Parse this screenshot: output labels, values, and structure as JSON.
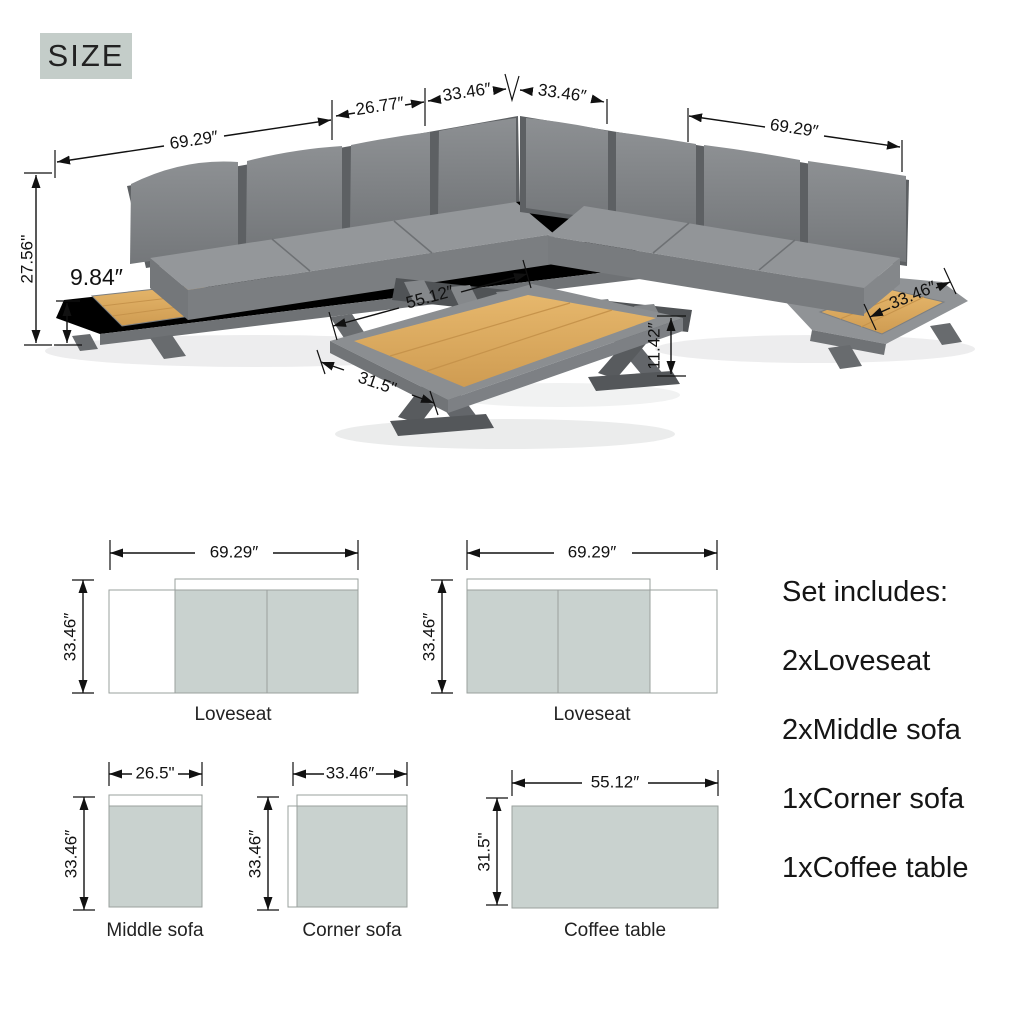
{
  "size_badge": "SIZE",
  "colors": {
    "badge_bg": "#c4cdc9",
    "diagram_fill": "#c9d2cf",
    "wood": "#ddab60",
    "sofa_gray": "#83868a",
    "dim_text": "#111111"
  },
  "main_view": {
    "dims": {
      "left_width": "69.29″",
      "middle_seat_width": "26.77″",
      "corner_seat_left": "33.46″",
      "corner_seat_right": "33.46″",
      "right_width": "69.29″",
      "overall_height": "27.56''",
      "side_table_height": "9.84″",
      "coffee_table_length": "55.12″",
      "coffee_table_width": "31.5\"",
      "coffee_table_height": "11.42″",
      "side_table_width": "33.46″"
    }
  },
  "diagrams": {
    "loveseat_left": {
      "label": "Loveseat",
      "width": "69.29″",
      "depth": "33.46″"
    },
    "loveseat_right": {
      "label": "Loveseat",
      "width": "69.29″",
      "depth": "33.46″"
    },
    "middle_sofa": {
      "label": "Middle sofa",
      "width": "26.5\"",
      "depth": "33.46″"
    },
    "corner_sofa": {
      "label": "Corner sofa",
      "width": "33.46″",
      "depth": "33.46″"
    },
    "coffee_table": {
      "label": "Coffee table",
      "width": "55.12″",
      "depth": "31.5\""
    }
  },
  "set_includes": {
    "title": "Set includes:",
    "items": [
      "2xLoveseat",
      "2xMiddle sofa",
      "1xCorner sofa",
      "1xCoffee table"
    ]
  }
}
